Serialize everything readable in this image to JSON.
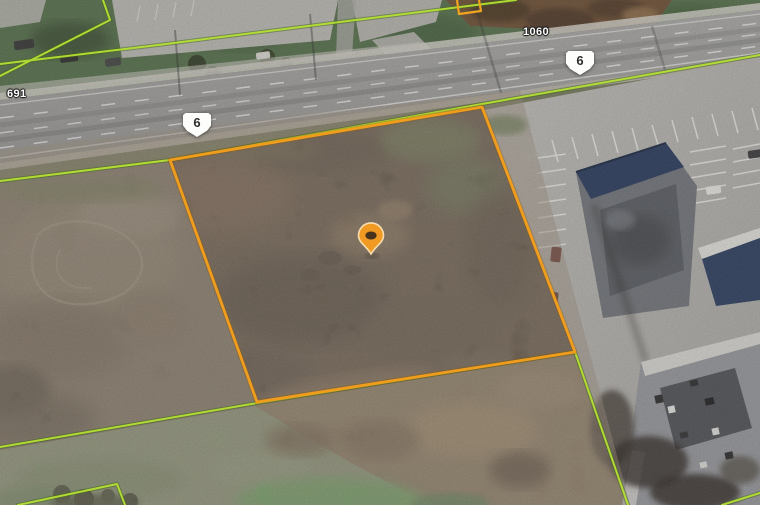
{
  "map": {
    "overlays": {
      "shield_left": "6",
      "shield_right": "6",
      "label_top": "1060",
      "label_left": "691"
    },
    "icons": {
      "pin": "location-pin"
    },
    "colors": {
      "parcel_boundary": "#F09D1E",
      "cadastral_line": "#B5E034",
      "pin": "#F09A23",
      "building_roof": "#2C3C5E"
    }
  }
}
